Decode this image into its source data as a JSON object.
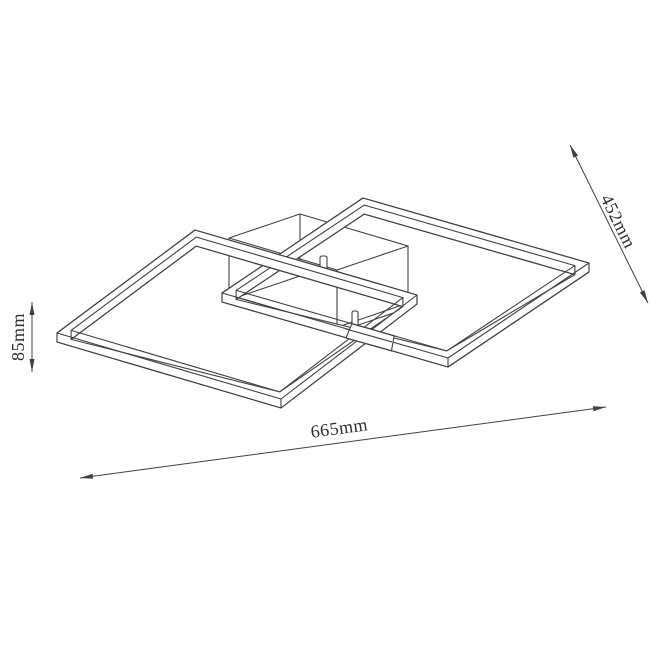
{
  "drawing": {
    "kind": "ceiling-light-fixture-technical-drawing",
    "dimensions": {
      "length": {
        "label": "665mm"
      },
      "depth": {
        "label": "452mm"
      },
      "height": {
        "label": "85mm"
      }
    },
    "style": {
      "line_color": "#414141",
      "text_color": "#2e2e2e",
      "background": "#ffffff"
    }
  }
}
